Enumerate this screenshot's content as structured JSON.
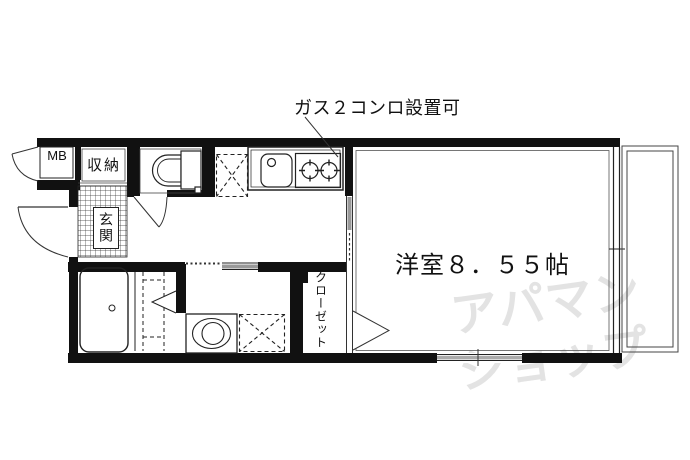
{
  "floorplan": {
    "annotation": {
      "gas_note": "ガス２コンロ設置可"
    },
    "labels": {
      "meter_box": "MB",
      "storage": "収納",
      "entrance": "玄関",
      "main_room": "洋室８．５５帖",
      "closet": "クローゼット"
    },
    "watermark": {
      "line1": "アパマン",
      "line2": "ショップ"
    },
    "symbols": [
      "toilet",
      "bathtub",
      "kitchen-sink",
      "gas-stove",
      "washing-machine",
      "refrigerator-space",
      "laundry-space",
      "door-swing",
      "sliding-door",
      "window",
      "balcony",
      "entrance-tile"
    ],
    "colors": {
      "wall": "#111111",
      "line": "#333333",
      "door_gray": "#999999",
      "watermark": "#e3e3e3"
    }
  }
}
